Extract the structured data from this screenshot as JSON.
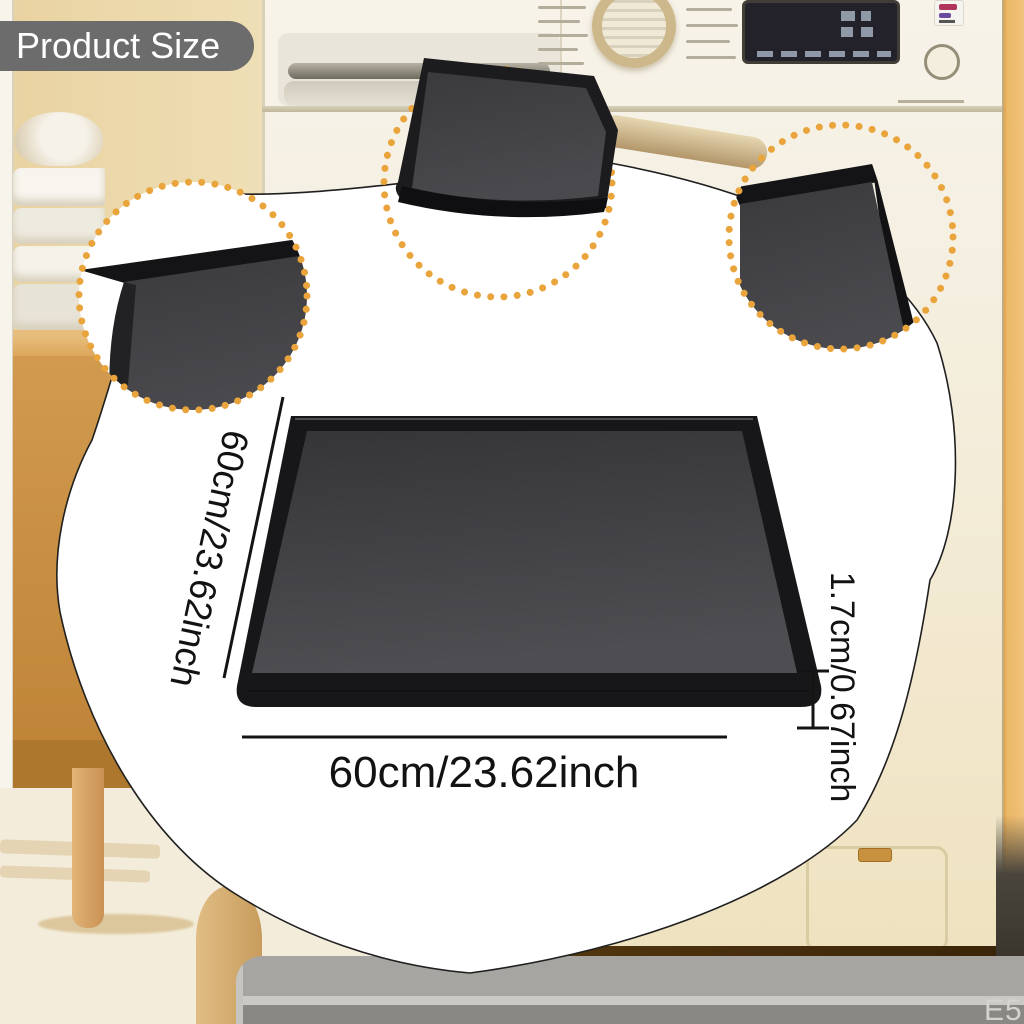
{
  "badge": {
    "label": "Product Size"
  },
  "dimensions": {
    "side": "60cm/23.62inch",
    "bottom": "60cm/23.62inch",
    "height": "1.7cm/0.67inch"
  },
  "watermark": "E5",
  "product": {
    "name": "washing machine silicone mat",
    "mat_color": "#3a3a3d"
  },
  "colors": {
    "accent_dots": "#e9a43c",
    "badge_bg": "#6c6c6c",
    "blob_outline": "#1f1f1f",
    "mat_surface": "#3f3f42",
    "mat_rim": "#141416",
    "floor_mat_gray": "#a7a5a1"
  }
}
